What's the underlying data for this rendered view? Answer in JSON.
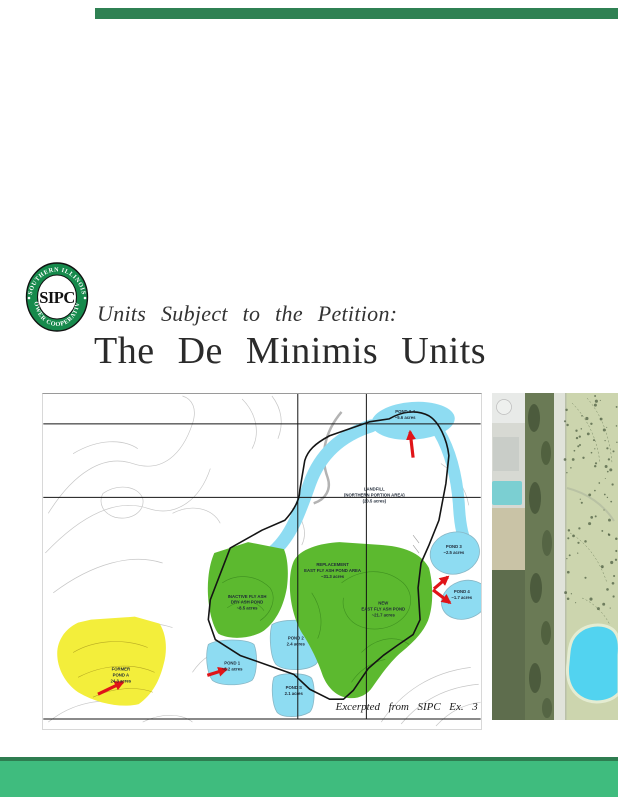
{
  "header": {
    "subtitle": "Units Subject to the Petition:",
    "title": "The De Minimis Units"
  },
  "logo": {
    "arc_top": "SOUTHERN ILLINOIS",
    "arc_bottom": "POWER COOPERATIVE",
    "acronym": "SIPC",
    "ring_color": "#168a4c"
  },
  "map": {
    "credit": "Excerpted from SIPC Ex. 3",
    "labels": {
      "pond34": [
        "POND 3-4",
        "~5.6 acres"
      ],
      "landfill": [
        "LANDFILL",
        "(NORTHERN PORTION AREA)",
        "(20.5 acres)"
      ],
      "inactive_ash": [
        "INACTIVE FLY ASH",
        "DRY ASH POND",
        "~8.5 acres"
      ],
      "replacement": [
        "REPLACEMENT",
        "EAST FLY ASH POND AREA",
        "~31.3 acres"
      ],
      "new_east": [
        "NEW",
        "EAST FLY ASH POND",
        "~21.7 acres"
      ],
      "former_pond_a": [
        "FORMER",
        "POND A",
        "24.3 acres"
      ],
      "pond1": [
        "POND 1",
        "~8.2 acres"
      ],
      "pond2": [
        "POND 2",
        "2.4 acres"
      ],
      "pond_s": [
        "POND S",
        "2.1 acres"
      ],
      "pond3": [
        "POND 3",
        "~2.5 acres"
      ],
      "pond4": [
        "POND 4",
        "~1.7 acres"
      ]
    },
    "colors": {
      "water": "#8edcf2",
      "green_unit": "#5cb92f",
      "yellow_unit": "#f3ee3b",
      "arrow": "#e01418"
    }
  },
  "footer": {
    "accent_dark": "#2e7d50",
    "accent_light": "#3fbc7e"
  }
}
